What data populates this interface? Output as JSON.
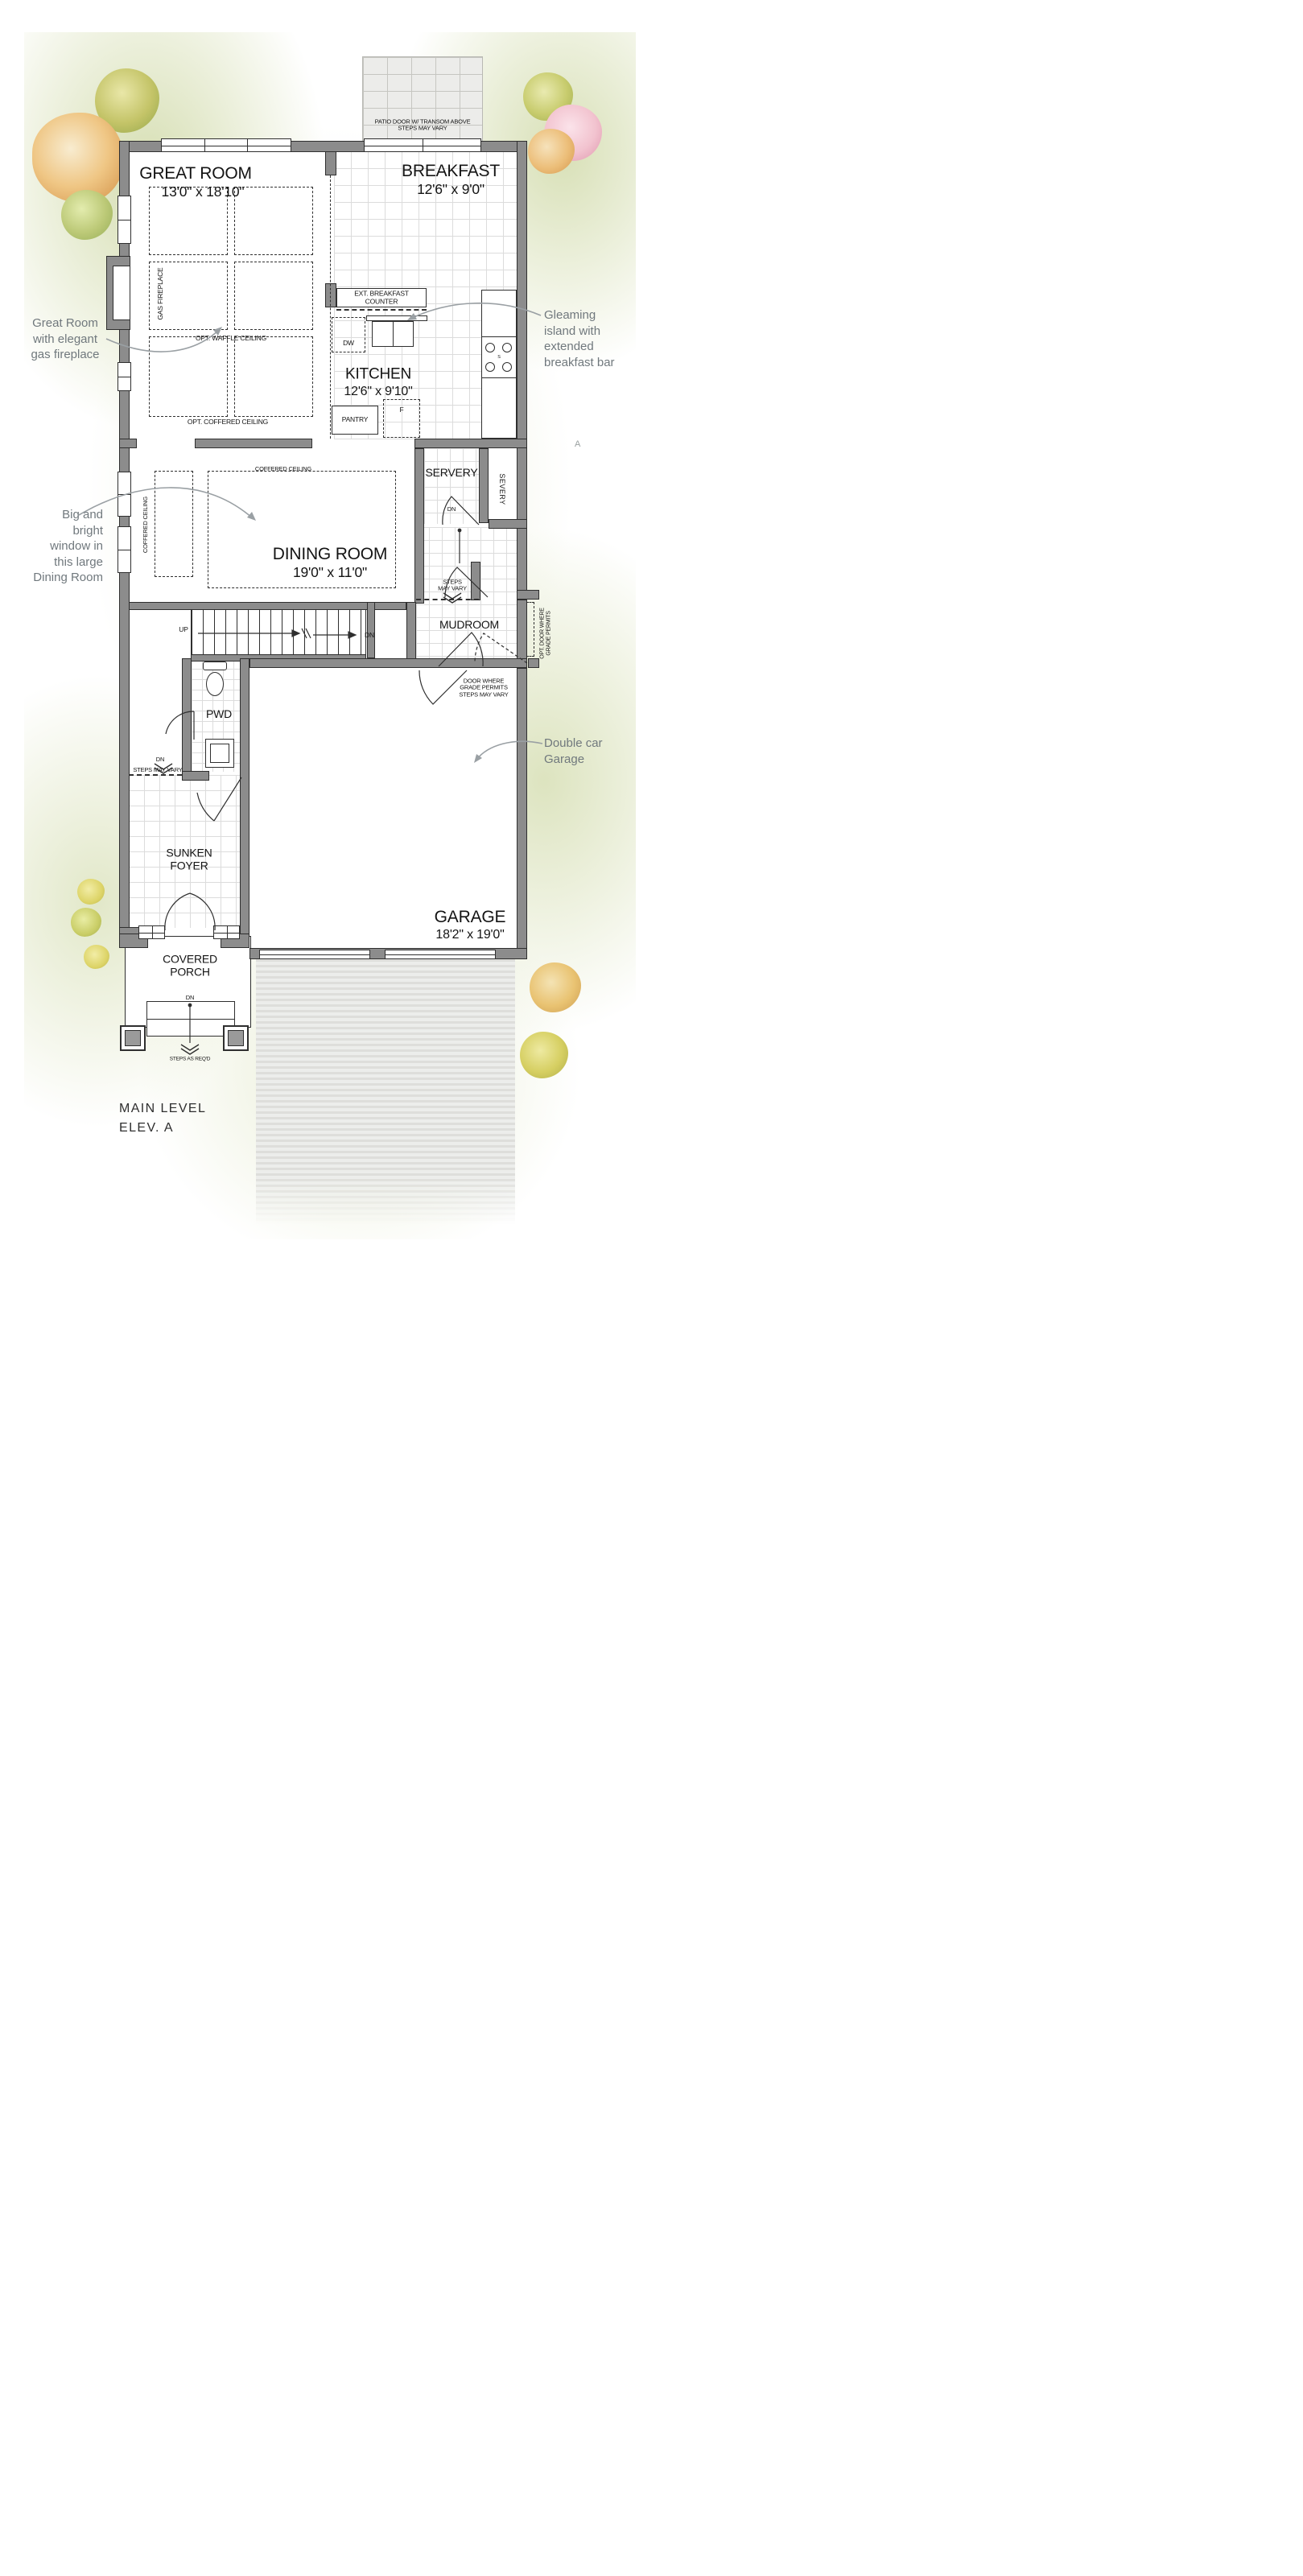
{
  "title": {
    "text": "MAIN LEVEL\nELEV. A"
  },
  "rooms": {
    "great_room": {
      "name": "GREAT ROOM",
      "dims": "13'0\" x 18'10\""
    },
    "breakfast": {
      "name": "BREAKFAST",
      "dims": "12'6\" x 9'0\""
    },
    "kitchen": {
      "name": "KITCHEN",
      "dims": "12'6\" x 9'10\""
    },
    "dining_room": {
      "name": "DINING ROOM",
      "dims": "19'0\" x 11'0\""
    },
    "garage": {
      "name": "GARAGE",
      "dims": "18'2\" x 19'0\""
    },
    "servery": "SERVERY",
    "mudroom": "MUDROOM",
    "powder_room": "PWD",
    "sunken_foyer": "SUNKEN\nFOYER",
    "covered_porch": "COVERED\nPORCH",
    "pantry": "PANTRY"
  },
  "labels": {
    "patio_note": "PATIO DOOR W/ TRANSOM ABOVE\nSTEPS MAY VARY",
    "ext_counter": "EXT. BREAKFAST COUNTER",
    "dw": "DW",
    "fridge": "F",
    "sink": "S",
    "gas_fireplace": "GAS FIREPLACE",
    "opt_waffle": "OPT. WAFFLE CEILING",
    "opt_coffered": "OPT. COFFERED CEILING",
    "coffered_h": "COFFERED CEILING",
    "coffered_v": "COFFERED CEILING",
    "servery_vert": "SEVERY",
    "steps_mudroom": "STEPS\nMAY VARY",
    "steps_hall": "STEPS MAY VARY",
    "opt_door": "OPT. DOOR WHERE\nGRADE PERMITS",
    "garage_door_note": "DOOR WHERE\nGRADE PERMITS\nSTEPS MAY VARY",
    "steps_porch": "STEPS AS REQ'D",
    "up": "UP",
    "dn_stairs": "DN",
    "dn_servery": "DN",
    "dn_hall": "DN",
    "dn_porch": "DN",
    "margin_letter": "A"
  },
  "annotations": {
    "fireplace": "Great Room\nwith elegant\ngas fireplace",
    "island": "Gleaming\nisland with\nextended\nbreakfast bar",
    "dining_window": "Big and\nbright\nwindow in\nthis large\nDining Room",
    "garage": "Double car\nGarage"
  },
  "colors": {
    "wall": "#8c8c8c",
    "line": "#2f2f2f",
    "annotation_text": "#70787d",
    "grass": "#ced8a4",
    "tree_olive": "#c2b960",
    "tree_orange": "#eebd7a",
    "tree_pink": "#f2c3cf",
    "tree_yellow": "#ded66a",
    "driveway": "#e7e8e5"
  }
}
